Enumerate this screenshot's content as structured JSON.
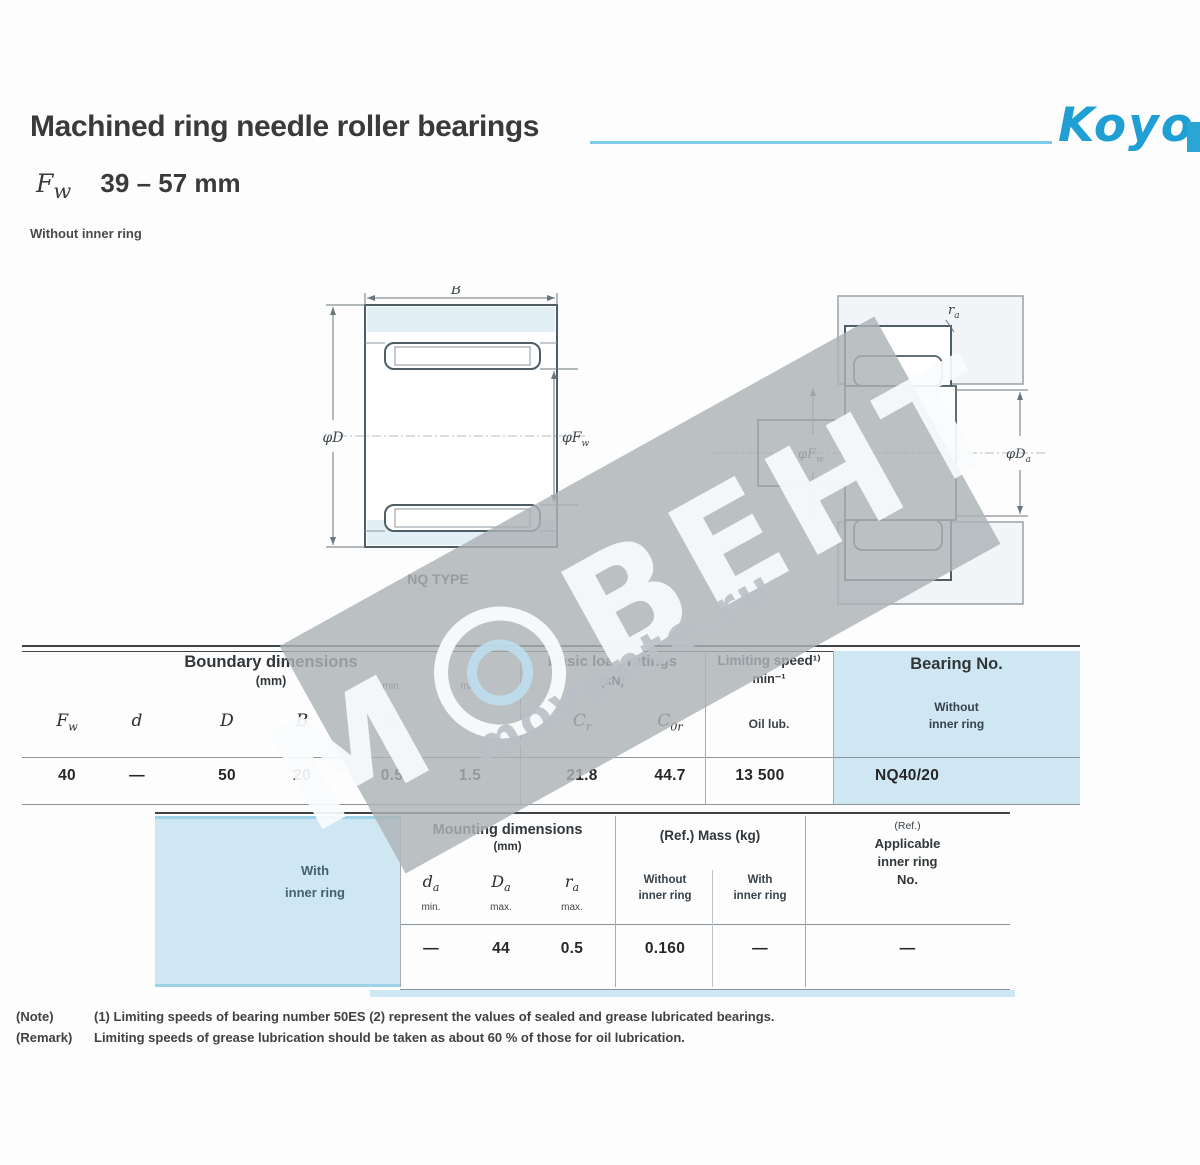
{
  "header": {
    "title": "Machined ring needle roller bearings",
    "brand": "Koyo",
    "range_sym_base": "F",
    "range_sym_sub": "w",
    "range_value": "39 – 57 mm",
    "variant": "Without inner ring"
  },
  "figure_left": {
    "dim_top": "B",
    "dim_left": "φD",
    "dim_right_base": "φF",
    "dim_right_sub": "w",
    "caption": "NQ TYPE"
  },
  "figure_right": {
    "dim_fillet_base": "r",
    "dim_fillet_sub": "a",
    "dim_bore_base": "φF",
    "dim_bore_sub": "w",
    "dim_housing_base": "φD",
    "dim_housing_sub": "a"
  },
  "table1": {
    "group_boundary": {
      "title": "Boundary dimensions",
      "unit": "(mm)"
    },
    "group_load": {
      "title": "Basic load ratings",
      "unit": "(kN)"
    },
    "group_speed": {
      "title": "Limiting speed¹⁾",
      "unit": "min⁻¹"
    },
    "group_bearing": {
      "title": "Bearing No.",
      "sub_line1": "Without",
      "sub_line2": "inner ring"
    },
    "cols": [
      {
        "base": "F",
        "sub": "w",
        "note": ""
      },
      {
        "base": "d",
        "sub": "",
        "note": ""
      },
      {
        "base": "D",
        "sub": "",
        "note": ""
      },
      {
        "base": "B",
        "sub": "",
        "note": ""
      },
      {
        "base": "r",
        "sub": "s",
        "note": "min."
      },
      {
        "base": "r",
        "sub": "1s",
        "note": "min."
      },
      {
        "base": "C",
        "sub": "r",
        "note": ""
      },
      {
        "base": "C",
        "sub": "0r",
        "note": ""
      }
    ],
    "speed_col": "Oil lub.",
    "row": {
      "fw": "40",
      "d": "—",
      "D": "50",
      "B": "20",
      "rs": "0.5",
      "r1s": "1.5",
      "cr": "21.8",
      "c0r": "44.7",
      "speed": "13 500",
      "bearing_no": "NQ40/20"
    }
  },
  "table2": {
    "left_header_line1": "With",
    "left_header_line2": "inner ring",
    "group_mounting": {
      "title": "Mounting dimensions",
      "unit": "(mm)"
    },
    "group_mass": {
      "title": "(Ref.)  Mass (kg)"
    },
    "group_ref": {
      "line1": "(Ref.)",
      "line2": "Applicable",
      "line3": "inner ring",
      "line4": "No."
    },
    "cols": [
      {
        "base": "d",
        "sub": "a",
        "note": "min."
      },
      {
        "base": "D",
        "sub": "a",
        "note": "max."
      },
      {
        "base": "r",
        "sub": "a",
        "note": "max."
      }
    ],
    "mass_cols": [
      {
        "line1": "Without",
        "line2": "inner ring"
      },
      {
        "line1": "With",
        "line2": "inner ring"
      }
    ],
    "row": {
      "da": "—",
      "Da": "44",
      "ra": "0.5",
      "mass_without": "0.160",
      "mass_with": "—",
      "inner_ring_no": "—"
    }
  },
  "notes": {
    "note_label": "(Note)",
    "note_text": "(1) Limiting speeds of bearing number 50ES  (2) represent the values of sealed and grease lubricated bearings.",
    "remark_label": "(Remark)",
    "remark_text": "Limiting speeds of grease lubrication should be taken as about 60 % of those for oil lubrication."
  },
  "watermark": {
    "letter": "М",
    "word": "ВЕНТ",
    "site": "movente.ru"
  },
  "colors": {
    "brand_blue": "#1f9fd4",
    "rule_cyan": "#7fcbe7",
    "table_blue": "#cfe7f3",
    "watermark_gray": "#acb2b6",
    "ink": "#3a3a3a"
  }
}
